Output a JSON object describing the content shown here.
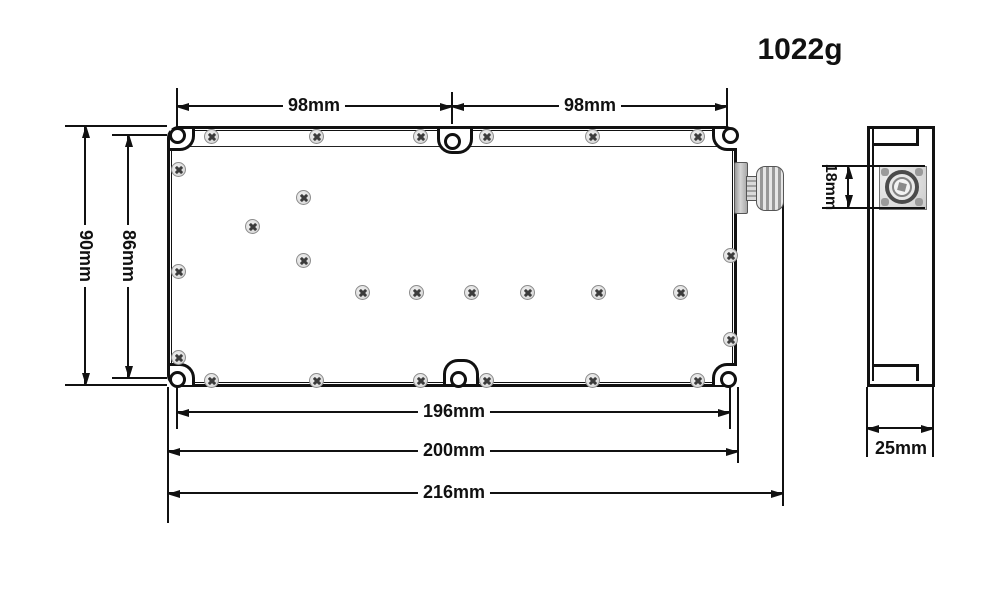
{
  "weight_label": "1022g",
  "front_view": {
    "dim_top_left": "98mm",
    "dim_top_right": "98mm",
    "dim_height_outer": "90mm",
    "dim_hole_height": "86mm",
    "dim_hole_width": "196mm",
    "dim_body_width": "200mm",
    "dim_total_width": "216mm"
  },
  "side_view": {
    "dim_connector_height": "18mm",
    "dim_body_depth": "25mm"
  },
  "colors": {
    "line": "#111111",
    "background": "#ffffff",
    "screw_fill": "#e0e0e0",
    "screw_cross": "#3c3c3c",
    "connector_metal": "#bfbfbf"
  },
  "icons": {
    "screw": "phillips-screw-icon",
    "mounting_hole": "mounting-hole-icon",
    "rf_connector": "rf-connector-icon"
  }
}
